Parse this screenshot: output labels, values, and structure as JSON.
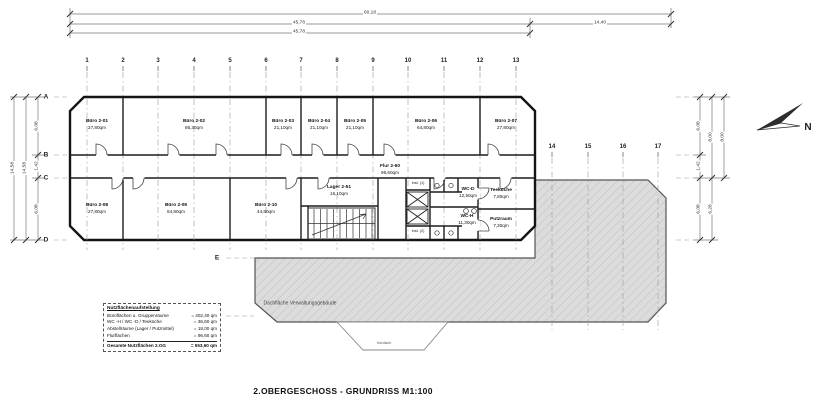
{
  "title": "2.OBERGESCHOSS - GRUNDRISS M1:100",
  "dims": [
    {
      "label": "60,18",
      "x": 370,
      "y": 14
    },
    {
      "label": "45,78",
      "x": 299,
      "y": 24
    },
    {
      "label": "14,40",
      "x": 600,
      "y": 24
    },
    {
      "label": "45,78",
      "x": 299,
      "y": 33
    },
    {
      "label": "14,58",
      "x": 14,
      "y": 168,
      "cls": "vert"
    },
    {
      "label": "14,58",
      "x": 26,
      "y": 168,
      "cls": "vert"
    },
    {
      "label": "6,08",
      "x": 38,
      "y": 126,
      "cls": "vert"
    },
    {
      "label": "1,42",
      "x": 38,
      "y": 166,
      "cls": "vert"
    },
    {
      "label": "6,08",
      "x": 38,
      "y": 209,
      "cls": "vert"
    },
    {
      "label": "6,08",
      "x": 700,
      "y": 126,
      "cls": "vert"
    },
    {
      "label": "1,42",
      "x": 700,
      "y": 166,
      "cls": "vert"
    },
    {
      "label": "6,08",
      "x": 700,
      "y": 209,
      "cls": "vert"
    },
    {
      "label": "8,00",
      "x": 712,
      "y": 137,
      "cls": "vert"
    },
    {
      "label": "6,28",
      "x": 712,
      "y": 209,
      "cls": "vert"
    },
    {
      "label": "8,00",
      "x": 724,
      "y": 137,
      "cls": "vert"
    }
  ],
  "grid": {
    "top": [
      {
        "label": "1",
        "x": 87
      },
      {
        "label": "2",
        "x": 123
      },
      {
        "label": "3",
        "x": 158
      },
      {
        "label": "4",
        "x": 194
      },
      {
        "label": "5",
        "x": 230
      },
      {
        "label": "6",
        "x": 266
      },
      {
        "label": "7",
        "x": 301
      },
      {
        "label": "8",
        "x": 337
      },
      {
        "label": "9",
        "x": 373
      },
      {
        "label": "10",
        "x": 408
      },
      {
        "label": "11",
        "x": 444
      },
      {
        "label": "12",
        "x": 480
      },
      {
        "label": "13",
        "x": 516
      }
    ],
    "right": [
      {
        "label": "14",
        "x": 552
      },
      {
        "label": "15",
        "x": 588
      },
      {
        "label": "16",
        "x": 623
      },
      {
        "label": "17",
        "x": 658
      }
    ],
    "rows": [
      {
        "label": "A",
        "x": 46,
        "y": 97
      },
      {
        "label": "B",
        "x": 46,
        "y": 155
      },
      {
        "label": "C",
        "x": 46,
        "y": 178
      },
      {
        "label": "D",
        "x": 46,
        "y": 240
      },
      {
        "label": "E",
        "x": 217,
        "y": 258
      },
      {
        "label": "F",
        "x": 217,
        "y": 316
      }
    ]
  },
  "rooms": [
    {
      "name": "Büro 2-01",
      "area": "27,80qm",
      "x": 97,
      "y": 125
    },
    {
      "name": "Büro 2-02",
      "area": "86,30qm",
      "x": 194,
      "y": 125
    },
    {
      "name": "Büro 2-03",
      "area": "21,10qm",
      "x": 283,
      "y": 125
    },
    {
      "name": "Büro 2-04",
      "area": "21,10qm",
      "x": 319,
      "y": 125
    },
    {
      "name": "Büro 2-05",
      "area": "21,10qm",
      "x": 355,
      "y": 125
    },
    {
      "name": "Büro 2-06",
      "area": "64,80qm",
      "x": 426,
      "y": 125
    },
    {
      "name": "Büro 2-07",
      "area": "27,80qm",
      "x": 506,
      "y": 125
    },
    {
      "name": "Büro 2-08",
      "area": "27,80qm",
      "x": 97,
      "y": 209
    },
    {
      "name": "Büro 2-09",
      "area": "64,80qm",
      "x": 176,
      "y": 209
    },
    {
      "name": "Büro 2-10",
      "area": "44,80qm",
      "x": 266,
      "y": 209
    },
    {
      "name": "Lager 2-51",
      "area": "16,10qm",
      "x": 339,
      "y": 191
    },
    {
      "name": "Flur 2-60",
      "area": "96,60qm",
      "x": 390,
      "y": 170
    },
    {
      "name": "WC-D",
      "area": "12,50qm",
      "x": 468,
      "y": 193
    },
    {
      "name": "WC-H",
      "area": "11,30qm",
      "x": 467,
      "y": 220
    },
    {
      "name": "Teeküche",
      "area": "7,80qm",
      "x": 501,
      "y": 194
    },
    {
      "name": "Putzraum",
      "area": "7,30qm",
      "x": 501,
      "y": 223
    }
  ],
  "notes": [
    {
      "label": "Inst. (1)",
      "x": 418,
      "y": 184,
      "cls": "tiny"
    },
    {
      "label": "Inst. (2)",
      "x": 418,
      "y": 232,
      "cls": "tiny"
    },
    {
      "label": "Dachfläche Verwaltungsgebäude",
      "x": 300,
      "y": 304,
      "cls": "roof"
    },
    {
      "label": "Vordach",
      "x": 384,
      "y": 343,
      "cls": "vordach"
    },
    {
      "label": "N",
      "x": 808,
      "y": 128,
      "cls": "north"
    }
  ],
  "legend": {
    "title": "Nutzflächenaufstellung",
    "rows": [
      {
        "label": "Büroflächen u. Gruppenräume",
        "value": "= 402,40 qm"
      },
      {
        "label": "WC -H / WC -D / Teeküche",
        "value": "= 36,60 qm"
      },
      {
        "label": "Abstellräume (Lager / Putzmittel)",
        "value": "= 18,00 qm"
      },
      {
        "label": "Flurflächen",
        "value": "= 96,60 qm"
      }
    ],
    "total": {
      "label": "Gesamte Nutzflächen 2.OG",
      "value": "= 553,60 qm"
    }
  }
}
